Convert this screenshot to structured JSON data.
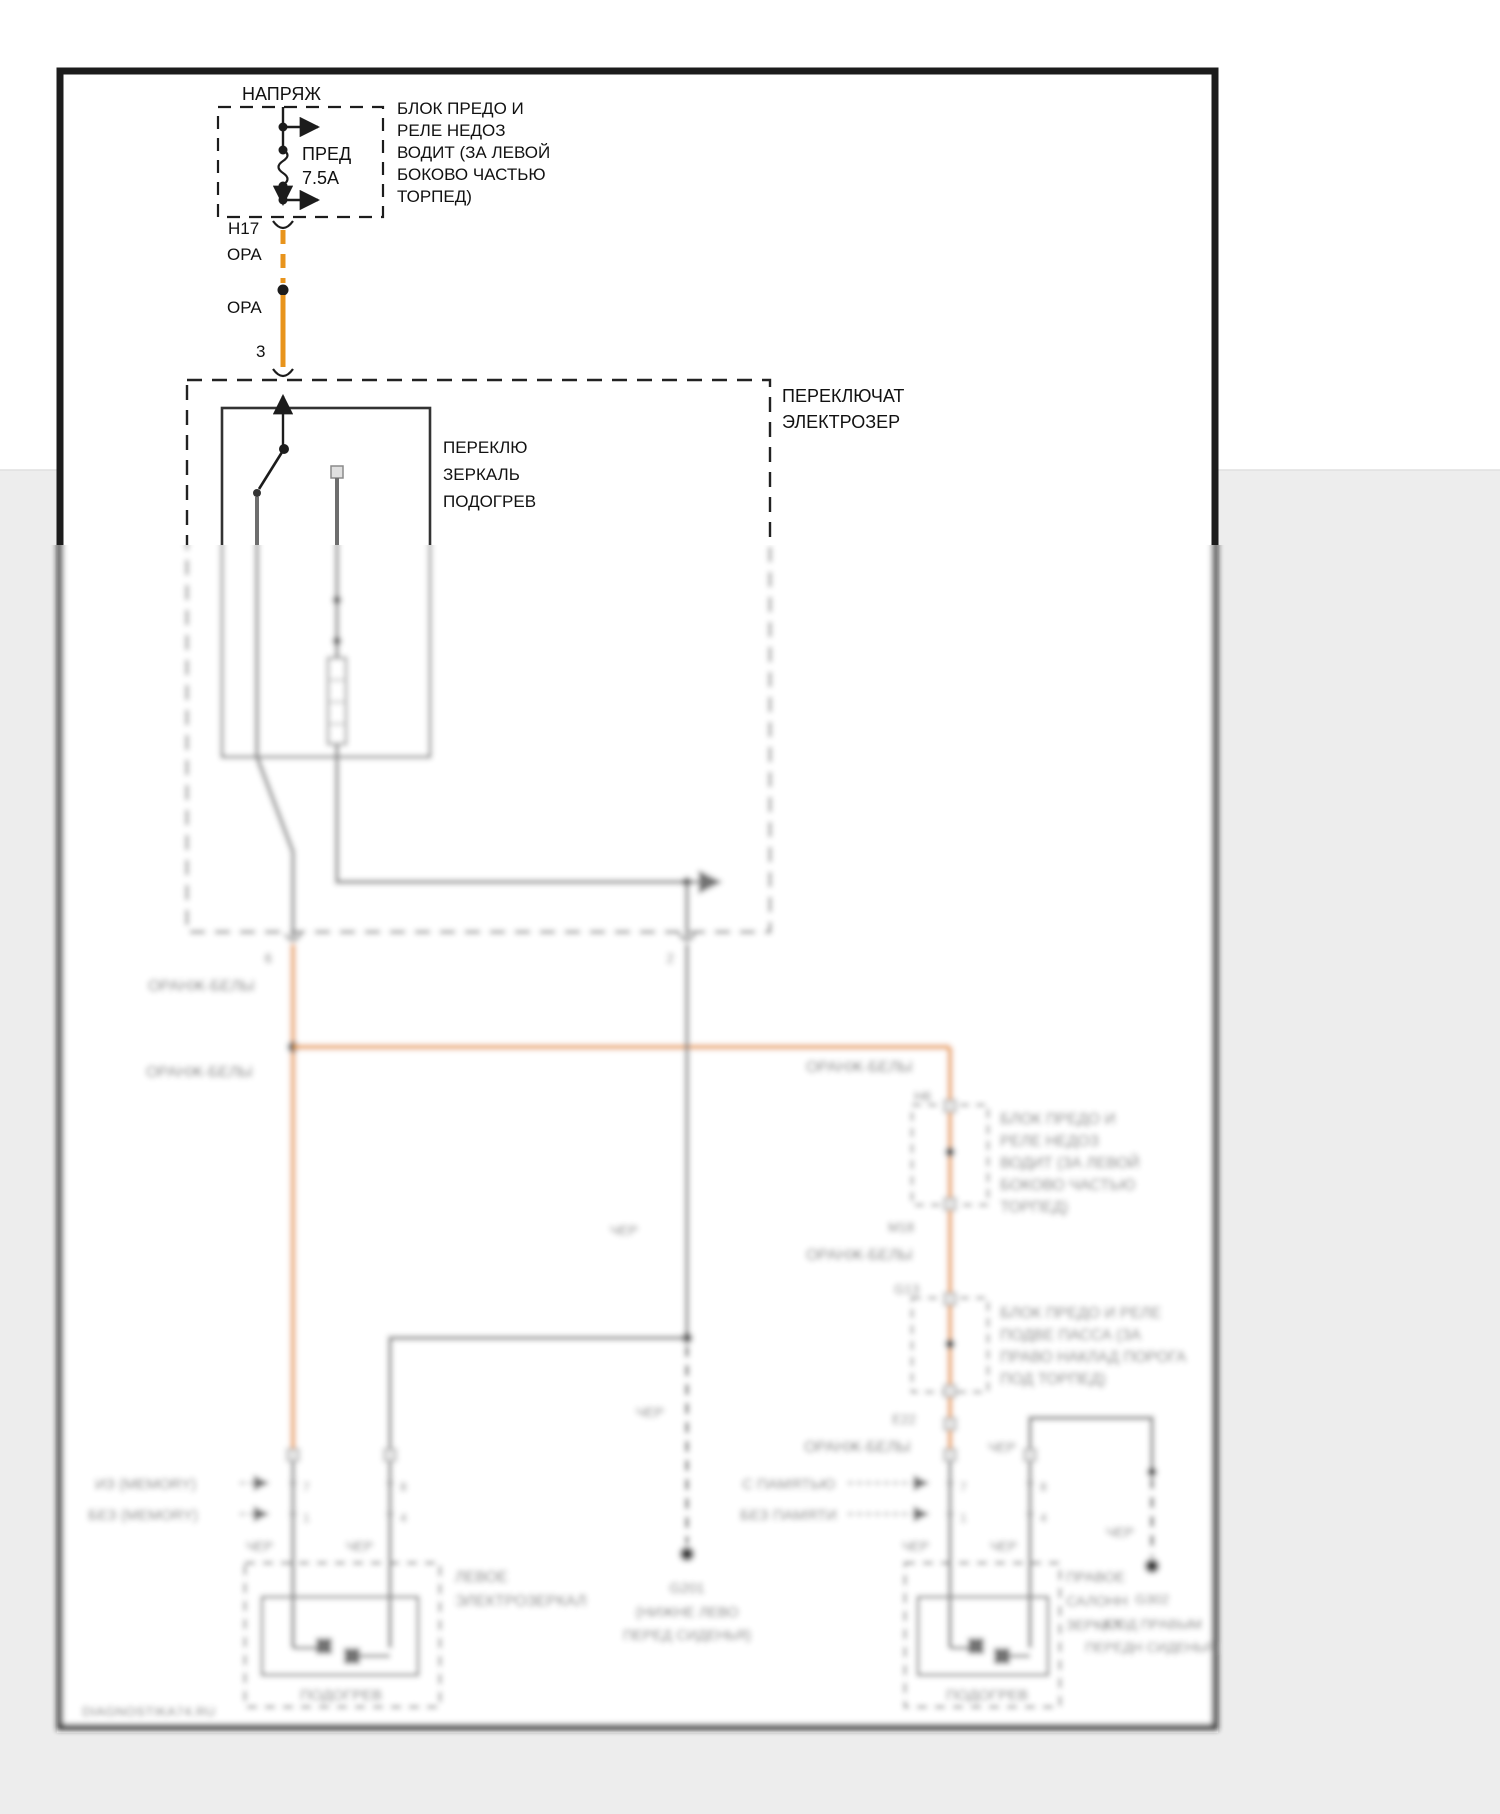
{
  "colors": {
    "wire_orange": "#e8941c",
    "wire_gray": "#6e6e6e",
    "line_black": "#1c1c1c",
    "margin_gray": "#ededed"
  },
  "power": {
    "source_label": "НАПРЯЖ",
    "fuse_name": "ПРЕД",
    "fuse_rating": "7.5А",
    "location_note": [
      "БЛОК ПРЕДО И",
      "РЕЛЕ НЕДОЗ",
      "ВОДИТ (ЗА ЛЕВОЙ",
      "БОКОВО ЧАСТЬЮ",
      "ТОРПЕД)"
    ],
    "connector": "Н17",
    "wire_color_dashed": "ОРА",
    "wire_color_solid": "ОРА",
    "pin": "3"
  },
  "mirror_switch": {
    "name": [
      "ПЕРЕКЛЮЧАТ",
      "ЭЛЕКТРОЗЕР"
    ],
    "function": [
      "ПЕРЕКЛЮ",
      "ЗЕРКАЛЬ",
      "ПОДОГРЕВ"
    ],
    "pin_out_left": "6",
    "pin_out_right": "2"
  },
  "wire_labels": {
    "orange_white": "ОРАНЖ-БЕЛЫ",
    "black": "ЧЕР"
  },
  "right_feed": {
    "connector_h6": "Н6",
    "fuse_block_1_note": [
      "БЛОК ПРЕДО И",
      "РЕЛЕ НЕДОЗ",
      "ВОДИТ (ЗА ЛЕВОЙ",
      "БОКОВО ЧАСТЬЮ",
      "ТОРПЕД)"
    ],
    "connector_m18": "М18",
    "connector_g13": "G13",
    "fuse_block_2_note": [
      "БЛОК ПРЕДО И РЕЛЕ",
      "ПОДВЕ ПАССА (ЗА",
      "ПРАВО НАКЛАД ПОРОГА",
      "ПОД ТОРПЕД)"
    ],
    "connector_e22": "Е22"
  },
  "left_mirror": {
    "variant_with": "ИЗ (MEMORY)",
    "variant_without": "БЕЗ (MEMORY)",
    "pins": [
      "7",
      "1",
      "8",
      "4"
    ],
    "name": [
      "ЛЕВОЕ",
      "ЭЛЕКТРОЗЕРКАЛ"
    ],
    "heater": "ПОДОГРЕВ"
  },
  "right_mirror": {
    "variant_with": "С ПАМЯТЬЮ",
    "variant_without": "БЕЗ ПАМЯТИ",
    "pins": [
      "7",
      "1",
      "8",
      "4"
    ],
    "name": [
      "ПРАВОЕ",
      "САЛОНН",
      "ЗЕРКАЛ"
    ],
    "heater": "ПОДОГРЕВ"
  },
  "grounds": {
    "left": [
      "G201",
      "(НИЖНЕ ЛЕВО",
      "ПЕРЕД СИДЕНЬЯ)"
    ],
    "right": [
      "G302",
      "(ПОД ПРАВЫМ",
      "ПЕРЕДН СИДЕНЬЯ)"
    ]
  },
  "watermark": "DIAGNOSTIKA74.RU"
}
